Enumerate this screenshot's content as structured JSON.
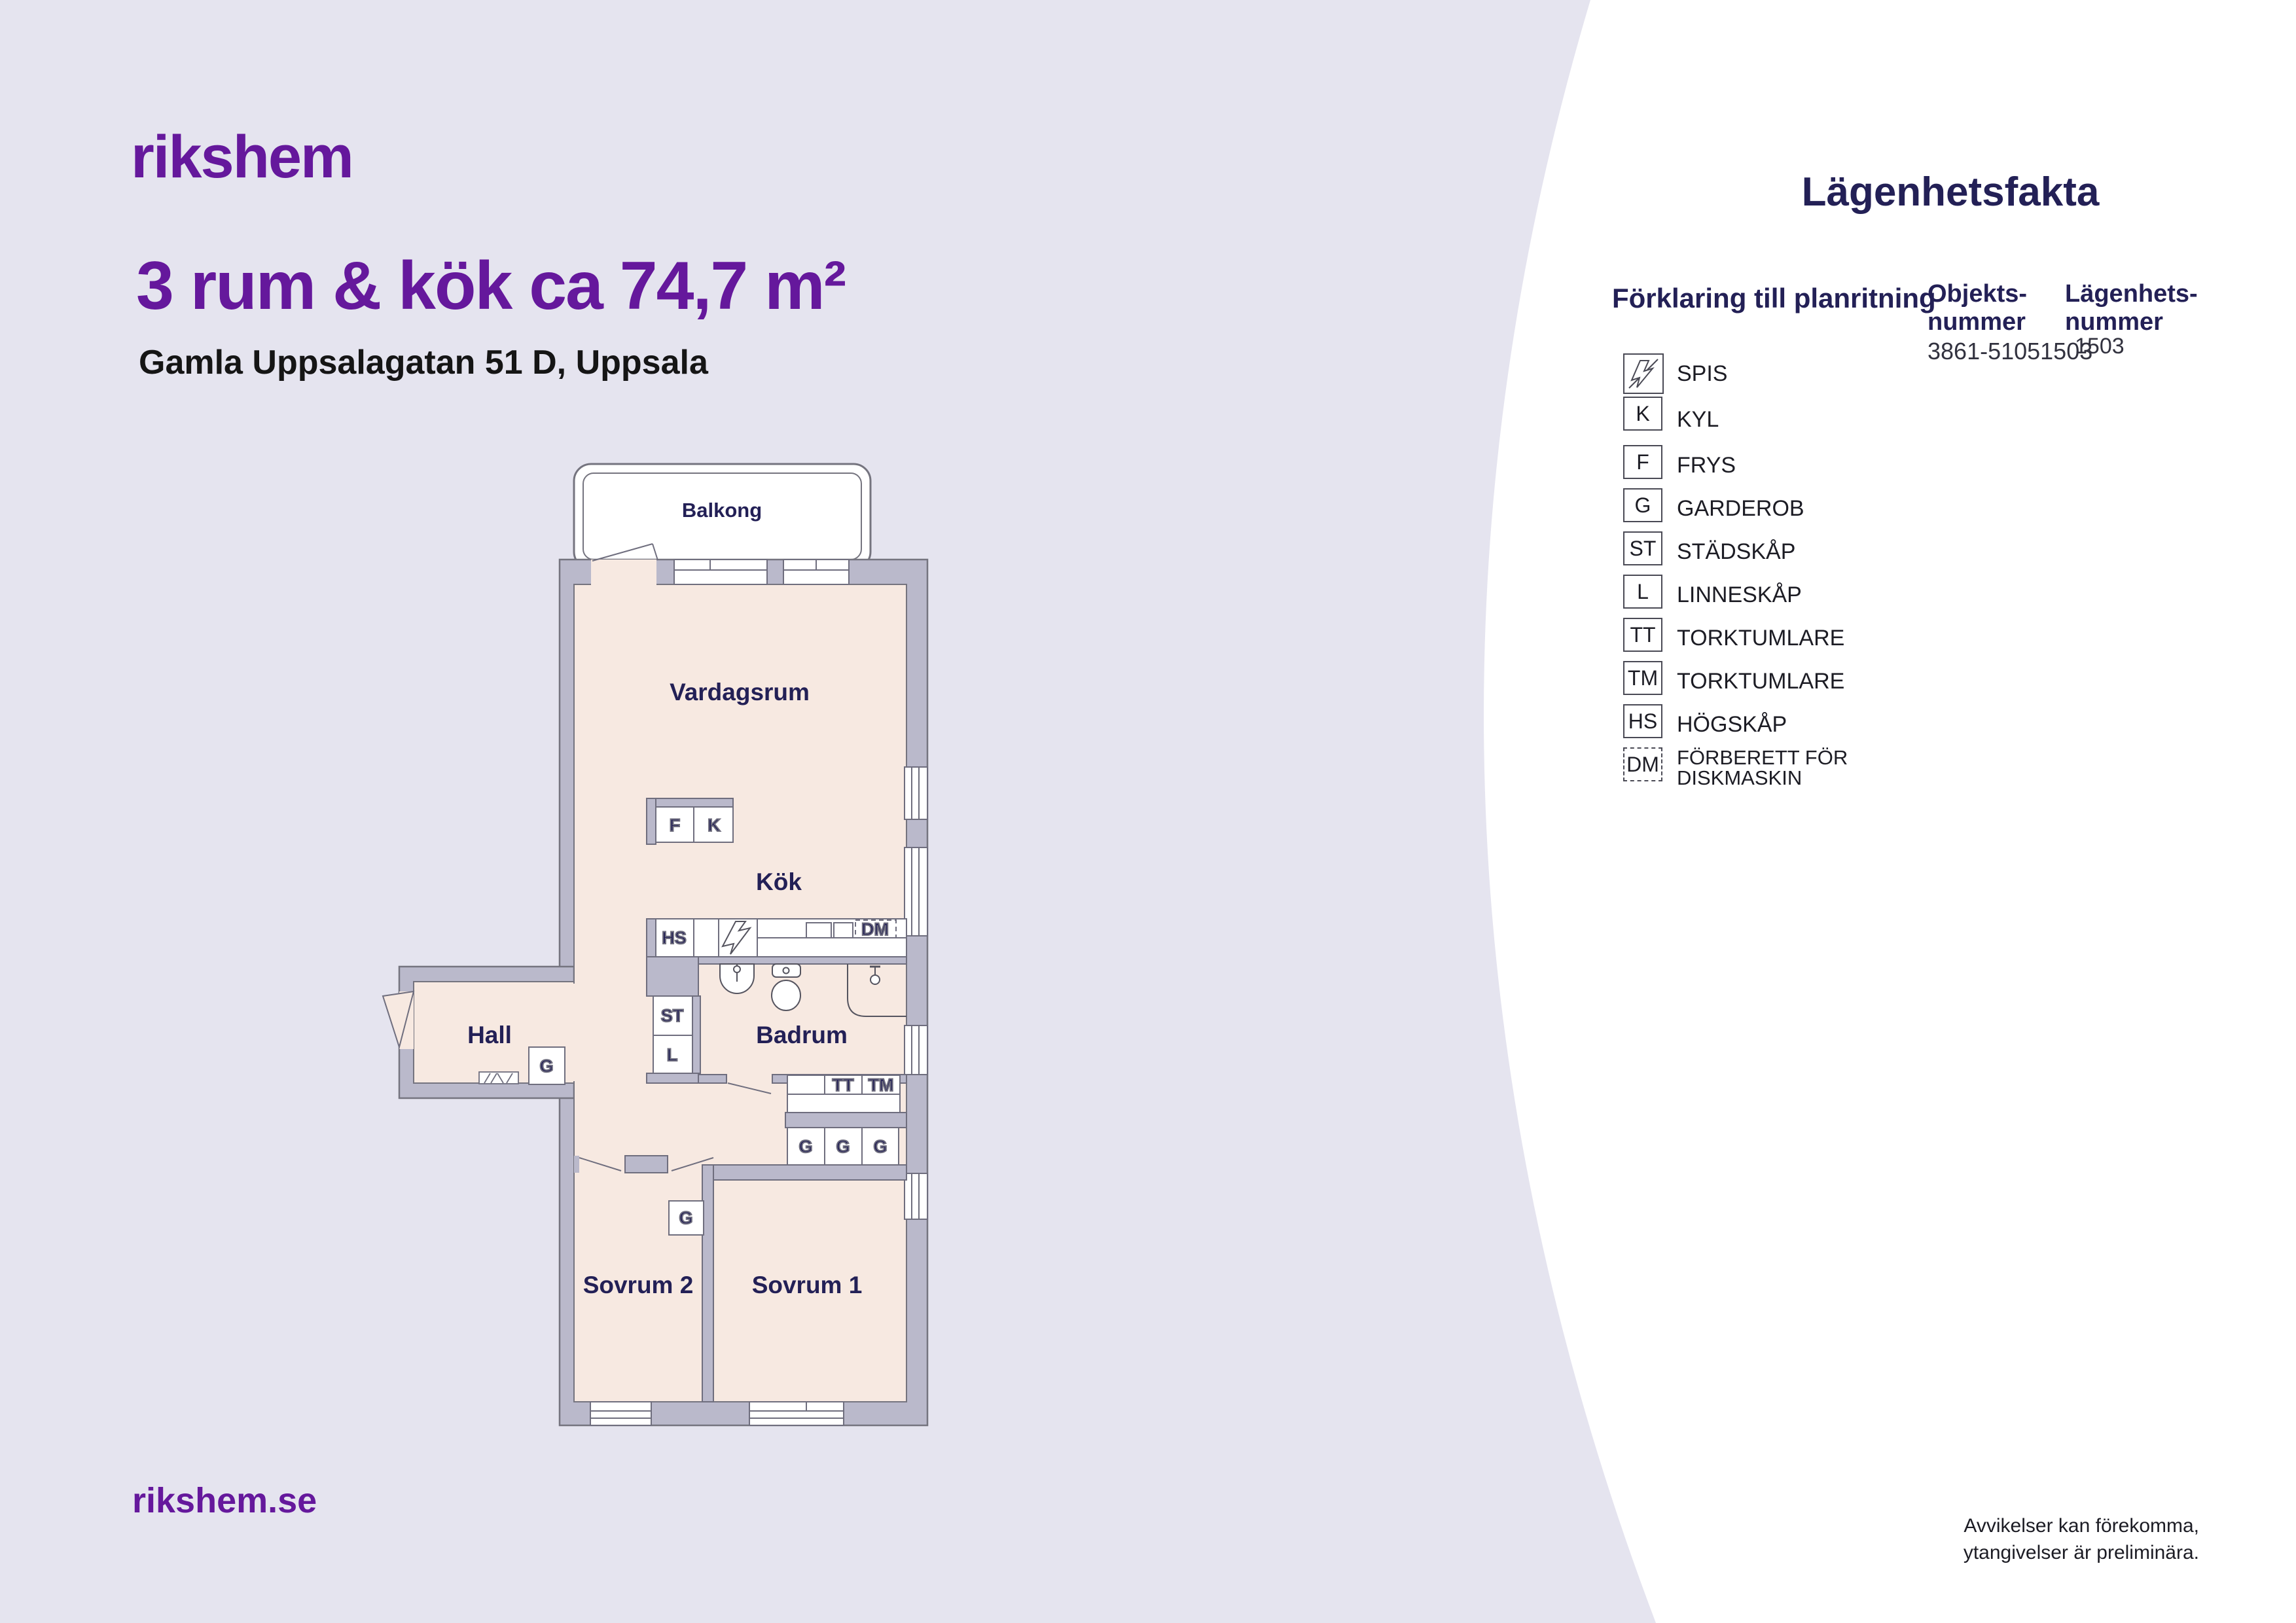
{
  "brand": {
    "logo_text": "rikshem",
    "website": "rikshem.se",
    "purple": "#65189c",
    "navy": "#232056"
  },
  "header": {
    "title": "3 rum & kök ca 74,7 m²",
    "address": "Gamla Uppsalagatan 51 D, Uppsala"
  },
  "facts": {
    "panel_title": "Lägenhetsfakta",
    "legend_title": "Förklaring till planritning",
    "object_label": "Objekts-\nnummer",
    "object_value": "3861-51051503",
    "apartment_label": "Lägenhets-\nnummer",
    "apartment_value": "1503"
  },
  "legend": {
    "items": [
      {
        "icon": "lightning-icon",
        "box": "",
        "label": "SPIS"
      },
      {
        "icon": "",
        "box": "K",
        "label": "KYL"
      },
      {
        "icon": "",
        "box": "F",
        "label": "FRYS"
      },
      {
        "icon": "",
        "box": "G",
        "label": "GARDEROB"
      },
      {
        "icon": "",
        "box": "ST",
        "label": "STÄDSKÅP"
      },
      {
        "icon": "",
        "box": "L",
        "label": "LINNESKÅP"
      },
      {
        "icon": "",
        "box": "TT",
        "label": "TORKTUMLARE"
      },
      {
        "icon": "",
        "box": "TM",
        "label": "TORKTUMLARE"
      },
      {
        "icon": "",
        "box": "HS",
        "label": "HÖGSKÅP"
      },
      {
        "icon": "",
        "box": "DM",
        "label": "FÖRBERETT FÖR\nDISKMASKIN"
      }
    ]
  },
  "plan": {
    "rooms": {
      "balkong": "Balkong",
      "vardagsrum": "Vardagsrum",
      "kok": "Kök",
      "hall": "Hall",
      "badrum": "Badrum",
      "sovrum1": "Sovrum 1",
      "sovrum2": "Sovrum 2"
    },
    "boxes": {
      "f": "F",
      "k": "K",
      "hs": "HS",
      "st": "ST",
      "l": "L",
      "g": "G",
      "tt": "TT",
      "tm": "TM",
      "dm": "DM"
    },
    "colors": {
      "wall": "#bab9cb",
      "floor": "#f7e9e1",
      "line": "#75747f"
    }
  },
  "footer": {
    "disclaimer": "Avvikelser kan förekomma,\nytangivelser är preliminära."
  }
}
